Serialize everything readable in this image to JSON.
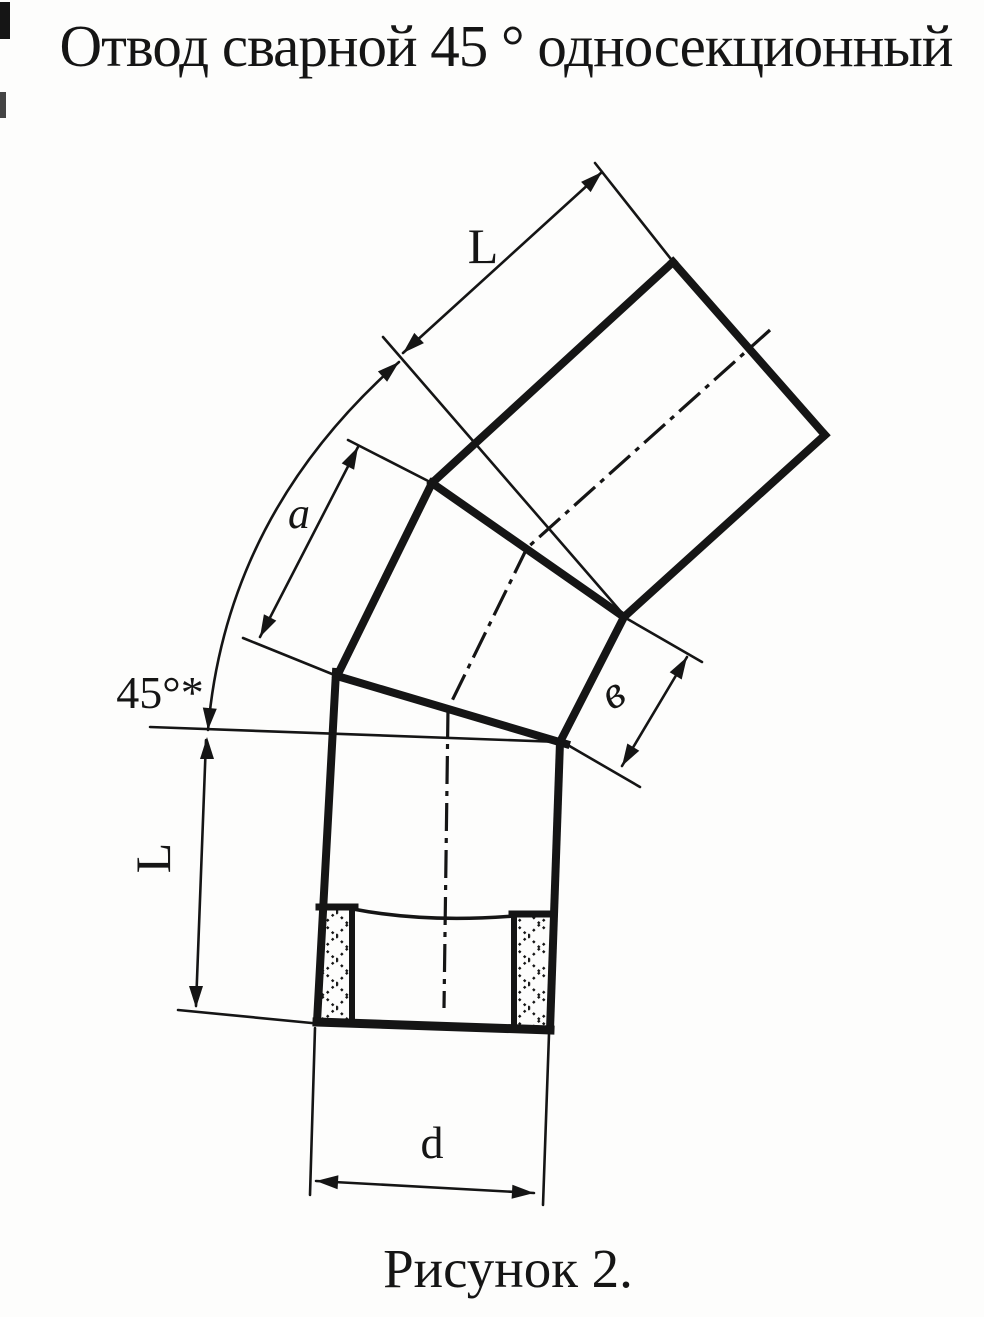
{
  "title": "Отвод сварной 45 ° односекционный",
  "caption": "Рисунок 2.",
  "labels": {
    "length_top": "L",
    "angle": "45°*",
    "section_outer": "a",
    "section_inner": "в",
    "length_left": "L",
    "diameter": "d"
  },
  "colors": {
    "ink": "#151515",
    "paper": "#fdfdfc"
  }
}
